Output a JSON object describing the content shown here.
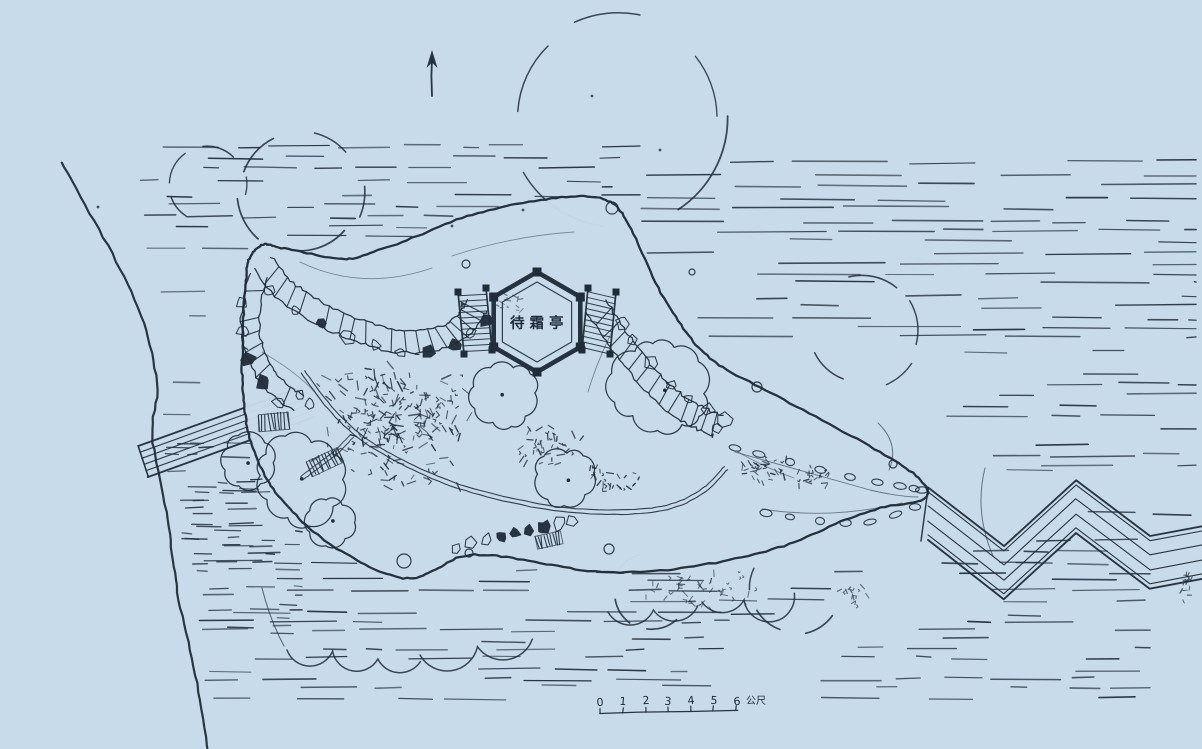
{
  "colors": {
    "paper": "#c7dbeb",
    "ink": "#202c39"
  },
  "pavilion": {
    "label": "待霜亭"
  },
  "scale_bar": {
    "ticks": [
      "0",
      "1",
      "2",
      "3",
      "4",
      "5",
      "6"
    ],
    "unit": "公尺"
  },
  "compass": {
    "icon": "north-arrow"
  }
}
